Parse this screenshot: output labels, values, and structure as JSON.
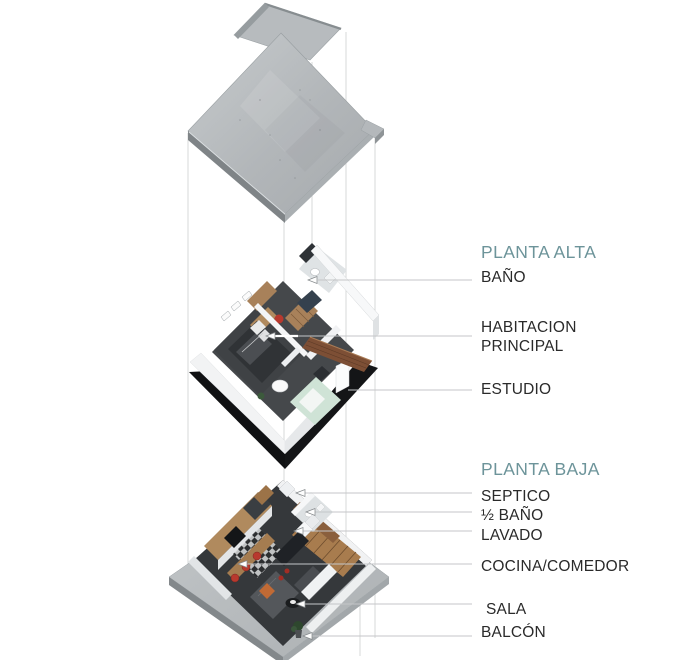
{
  "title": "Exploded axonometric house plan",
  "theme": {
    "heading_color": "#6D949A",
    "label_color": "#2A2A2A",
    "leader_color": "#C4C6C8",
    "guide_color": "#D3D5D6",
    "concrete_color": "#B7BBBE",
    "base_color": "#B4B8BB",
    "floor_color": "#45484B",
    "wood_color": "#B08A5E",
    "wood_dark_color": "#7D4F35",
    "accent_red": "#B8392E",
    "mint_color": "#CFE3D6",
    "underside_color": "#101113",
    "wall_white": "#F2F3F4"
  },
  "sections": {
    "upper": {
      "heading": "PLANTA ALTA",
      "items": [
        {
          "id": "banio",
          "label": "BAÑO"
        },
        {
          "id": "habitacion",
          "label": "HABITACION PRINCIPAL"
        },
        {
          "id": "estudio",
          "label": "ESTUDIO"
        }
      ]
    },
    "lower": {
      "heading": "PLANTA BAJA",
      "items": [
        {
          "id": "septico",
          "label": "SEPTICO"
        },
        {
          "id": "medio-banio",
          "label": "½ BAÑO"
        },
        {
          "id": "lavado",
          "label": "LAVADO"
        },
        {
          "id": "cocina",
          "label": "COCINA/COMEDOR"
        },
        {
          "id": "sala",
          "label": "SALA"
        },
        {
          "id": "balcon",
          "label": "BALCÓN"
        }
      ]
    }
  }
}
